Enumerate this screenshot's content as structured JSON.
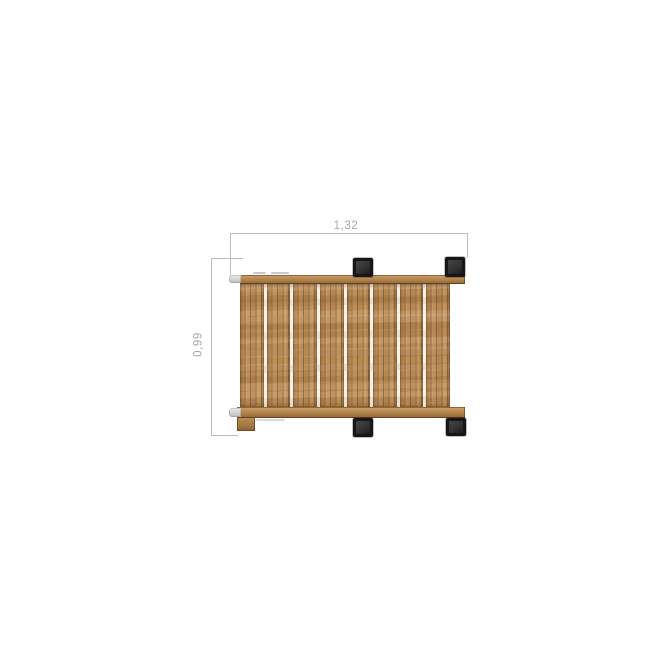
{
  "drawing": {
    "dimensions": {
      "width_label": "1,32",
      "height_label": "0,99"
    },
    "structure": {
      "slat_count": 8,
      "leg_cap_count": 4
    },
    "colors": {
      "background": "#ffffff",
      "dim_line": "#bcbcbc",
      "dim_text": "#a6a6a6",
      "wood_light": "#c79a63",
      "wood_mid": "#b28350",
      "wood_dark": "#8a5f33",
      "wood_seam": "#6f4c24",
      "slat_gap": "#f6f1e8",
      "leg_outer": "#161616",
      "leg_inner": "#323232",
      "metal_cap_light": "#ececec",
      "metal_cap_dark": "#bdbdbd"
    }
  }
}
